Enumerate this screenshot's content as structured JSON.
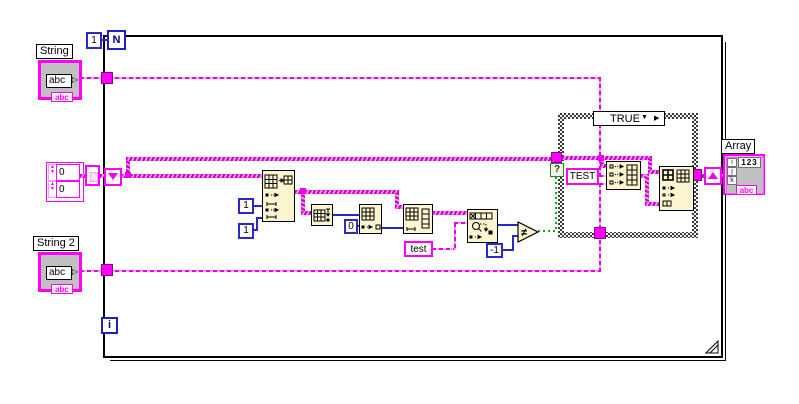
{
  "colors": {
    "string_wire": "#FF00FF",
    "numeric_wire": "#2828C8",
    "boolean_wire": "#00B400",
    "node_fill": "#FBF6D0",
    "control_fill": "#C0C0C0"
  },
  "for_loop": {
    "count_terminal": "N",
    "count_constant": "1",
    "iteration_terminal": "i"
  },
  "controls": {
    "string1": {
      "label": "String",
      "value": "abc",
      "type_tag": "abc",
      "dropdown_glyph": "▷"
    },
    "string2": {
      "label": "String 2",
      "value": "abc",
      "type_tag": "abc",
      "dropdown_glyph": "▷"
    },
    "array_indicator": {
      "label": "Array",
      "digital_display": "123",
      "index_labels": [
        "i",
        "j",
        "k"
      ],
      "type_tag": "abc"
    },
    "array_constant": {
      "values": [
        "0",
        "0"
      ]
    }
  },
  "constants": {
    "index_one_a": "1",
    "index_one_b": "1",
    "index_zero": "0",
    "minus_one": "-1",
    "test_string": "test",
    "case_string": "TEST"
  },
  "case_structure": {
    "selector_value": "TRUE",
    "dec_glyph": "▼",
    "inc_glyph": "▶",
    "selector_terminal": "?"
  },
  "comparison": {
    "not_equal_glyph": "≠"
  },
  "icons": {
    "shift_register_left": "down-triangle",
    "shift_register_right": "up-triangle",
    "node_icons": [
      "insert-into-array",
      "array-transform",
      "index-array",
      "index-array-row",
      "search-1d-array",
      "not-equal",
      "build-array",
      "replace-array-subset"
    ]
  }
}
